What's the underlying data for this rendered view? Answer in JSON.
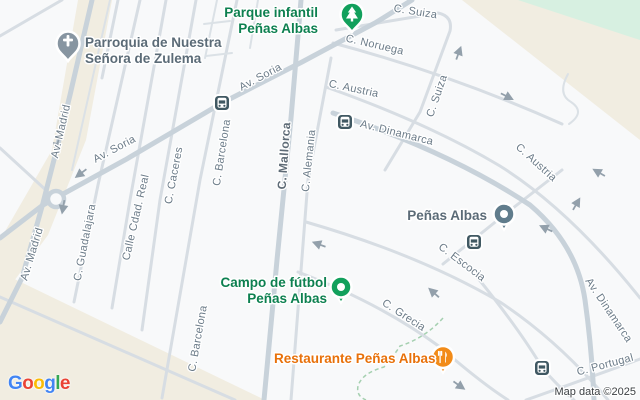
{
  "pois": {
    "parroquia": {
      "line1": "Parroquia de Nuestra",
      "line2": "Señora de Zulema"
    },
    "parque": {
      "line1": "Parque infantil",
      "line2": "Peñas Albas"
    },
    "penas_albas": {
      "label": "Peñas Albas"
    },
    "campo": {
      "line1": "Campo de fútbol",
      "line2": "Peñas Albas"
    },
    "restaurante": {
      "label": "Restaurante Peñas Albas"
    }
  },
  "streets": {
    "av_madrid_1": "Av. Madrid",
    "av_madrid_2": "Av. Madrid",
    "av_soria_1": "Av. Soria",
    "av_soria_2": "Av. Soria",
    "c_guadalajara": "C. Guadalajara",
    "calle_cdad_real": "Calle Cdad. Real",
    "c_caceres": "C. Caceres",
    "c_barcelona_1": "C. Barcelona",
    "c_barcelona_2": "C. Barcelona",
    "c_mallorca": "C. Mallorca",
    "c_alemania": "C. Alemania",
    "c_suiza_1": "C. Suiza",
    "c_suiza_2": "C. Suiza",
    "c_noruega": "C. Noruega",
    "c_austria_1": "C. Austria",
    "c_austria_2": "C. Austria",
    "av_dinamarca_1": "Av. Dinamarca",
    "av_dinamarca_2": "Av. Dinamarca",
    "c_escocia": "C. Escocia",
    "c_grecia": "C. Grecia",
    "c_portugal": "C. Portugal"
  },
  "icons": {
    "church_pin": "cross-in-teardrop",
    "park_pin": "tree-in-teardrop",
    "poi_dot_pin": "dot-in-circle",
    "restaurant_pin": "fork-knife-in-circle",
    "transit_stop": "bus-front",
    "one_way_arrow": "chevron-arrow"
  },
  "colors": {
    "land": "#f8f9fa",
    "beige_area": "#f1ede1",
    "green_area": "#d7f0e1",
    "road_major": "#c8d2da",
    "road_minor": "#d7dde3",
    "street_label": "#6b7b88",
    "poi_gray": "#5b6b77",
    "poi_green": "#0d8050",
    "poi_orange": "#e8710a",
    "pin_gray": "#8795a1",
    "pin_slate": "#607c8c",
    "pin_green": "#12a05c",
    "pin_orange": "#f28b18",
    "transit_icon": "#405862"
  },
  "attribution": {
    "map_data": "Map data ©2025",
    "logo_letters": [
      {
        "ch": "G",
        "color": "#4285F4"
      },
      {
        "ch": "o",
        "color": "#EA4335"
      },
      {
        "ch": "o",
        "color": "#FBBC05"
      },
      {
        "ch": "g",
        "color": "#4285F4"
      },
      {
        "ch": "l",
        "color": "#34A853"
      },
      {
        "ch": "e",
        "color": "#EA4335"
      }
    ]
  }
}
